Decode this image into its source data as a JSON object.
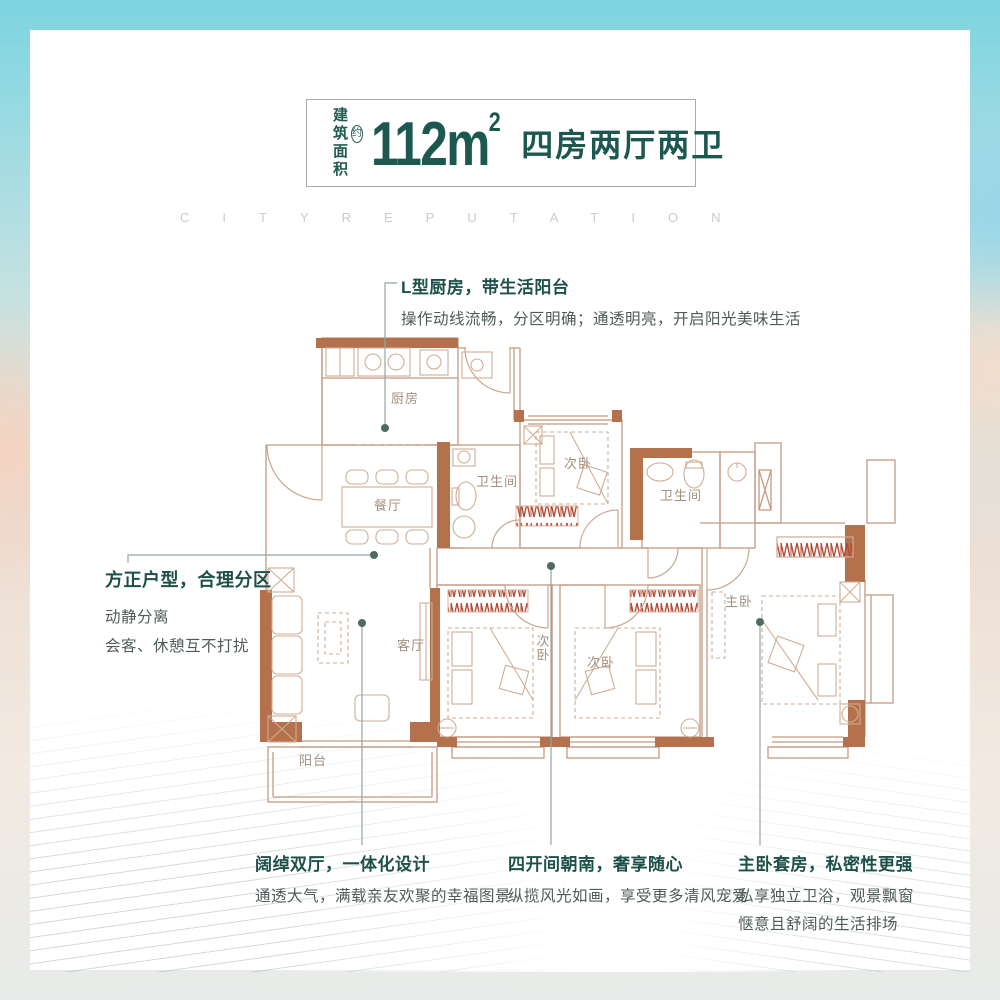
{
  "header": {
    "area_label_line1": "建筑",
    "area_label_line2": "面积",
    "approx_badge": "约",
    "area_value": "112m",
    "area_sup": "2",
    "layout_text": "四房两厅两卫"
  },
  "watermark": "CITYREPUTATION",
  "annotations": {
    "kitchen": {
      "title": "L型厨房，带生活阳台",
      "desc": "操作动线流畅，分区明确；通透明亮，开启阳光美味生活"
    },
    "layout": {
      "title": "方正户型，合理分区",
      "line1": "动静分离",
      "line2": "会客、休憩互不打扰"
    },
    "living": {
      "title": "阔绰双厅，一体化设计",
      "desc": "通透大气，满载亲友欢聚的幸福图景"
    },
    "south": {
      "title": "四开间朝南，奢享随心",
      "desc": "纵揽风光如画，享受更多清风宠爱"
    },
    "master": {
      "title": "主卧套房，私密性更强",
      "line1": "私享独立卫浴，观景飘窗",
      "line2": "惬意且舒阔的生活排场"
    }
  },
  "plan": {
    "rooms": {
      "kitchen": "厨房",
      "dining": "餐厅",
      "bath1": "卫生间",
      "bed_top": "次卧",
      "bath2": "卫生间",
      "living": "客厅",
      "bed_left": "次卧",
      "bed_mid": "次卧",
      "master": "主卧",
      "balcony": "阳台"
    }
  },
  "colors": {
    "accent_teal": "#1c584f",
    "wall_brown": "#b4714b",
    "wardrobe_red": "#b54a32",
    "plan_line_tan": "#c49a82",
    "watermark_gray": "#c9cccb",
    "callout_gray": "#93a5a4"
  }
}
